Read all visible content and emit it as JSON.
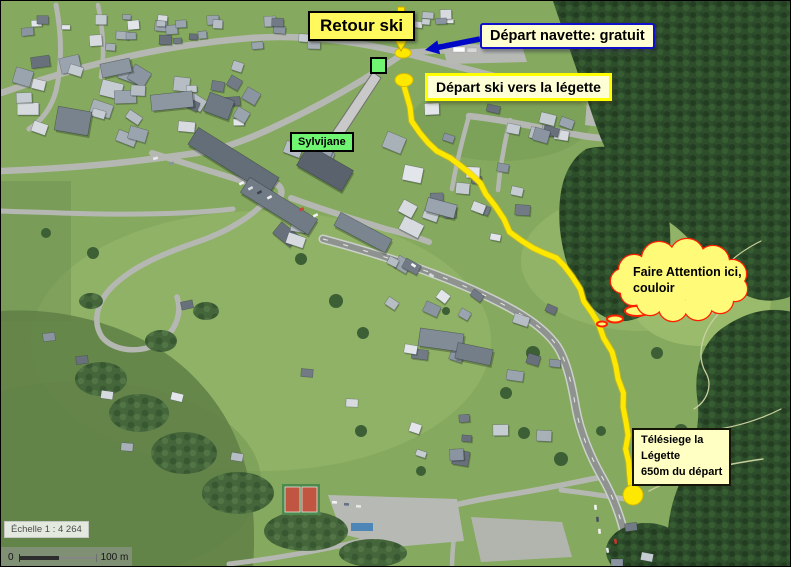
{
  "annotations": {
    "retour_ski": {
      "text": "Retour ski"
    },
    "depart_navette": {
      "text": "Départ navette: gratuit"
    },
    "depart_ski": {
      "text": "Départ ski vers la légette"
    },
    "sylvijane": {
      "text": "Sylvijane"
    },
    "warning": {
      "line1": "Faire Attention ici,",
      "line2": "couloir"
    },
    "telesiege": {
      "line1": "Télésiege la",
      "line2": "Légette",
      "line3": "650m du départ"
    }
  },
  "scale": {
    "label": "Échelle 1 : 4 264",
    "bar_start": "0",
    "bar_end": "100 m"
  },
  "colors": {
    "route_yellow": "#FFE800",
    "route_outline": "#E0BE00",
    "marker_yellow": "#FFE800",
    "marker_outline": "#D8B900",
    "cloud_fill": "#FFFA78",
    "warning_border_red": "#FF2000",
    "label_yellow_bg": "#FFF95E",
    "label_cream_bg": "#FFFFD6",
    "sylvijane_green": "#70F573",
    "navette_border_blue": "#0F0FCC",
    "arrow_blue": "#0008C8",
    "arrow_yellow": "#FFE800",
    "arrow_yellow_outline": "#C8A500",
    "callout_arrow_gray": "#C9C9C9"
  },
  "route": {
    "start": [
      403,
      85
    ],
    "points": [
      [
        405,
        92
      ],
      [
        408,
        106
      ],
      [
        412,
        120
      ],
      [
        418,
        132
      ],
      [
        427,
        142
      ],
      [
        437,
        150
      ],
      [
        448,
        157
      ],
      [
        459,
        164
      ],
      [
        469,
        172
      ],
      [
        478,
        182
      ],
      [
        486,
        193
      ],
      [
        494,
        205
      ],
      [
        502,
        218
      ],
      [
        510,
        231
      ],
      [
        520,
        240
      ],
      [
        532,
        247
      ],
      [
        544,
        252
      ],
      [
        554,
        257
      ],
      [
        564,
        265
      ],
      [
        572,
        276
      ],
      [
        578,
        288
      ],
      [
        584,
        300
      ],
      [
        590,
        311
      ],
      [
        597,
        323
      ],
      [
        604,
        337
      ],
      [
        610,
        351
      ],
      [
        615,
        365
      ],
      [
        618,
        378
      ],
      [
        621,
        392
      ],
      [
        623,
        406
      ],
      [
        625,
        420
      ],
      [
        626,
        434
      ],
      [
        626,
        448
      ],
      [
        627,
        461
      ],
      [
        628,
        473
      ],
      [
        631,
        484
      ]
    ],
    "end_circle": [
      632,
      494,
      10
    ],
    "start_ellipse": [
      403,
      79,
      9,
      6.5
    ],
    "shuttle_ellipse": [
      402,
      52,
      8,
      5
    ]
  },
  "markers": {
    "sylvijane_square": [
      370,
      57,
      15,
      15
    ]
  },
  "arrows": {
    "yellow_down": {
      "shaft": [
        396.5,
        6,
        7,
        28
      ],
      "head": [
        [
          391,
          34
        ],
        [
          409,
          34
        ],
        [
          400,
          50
        ]
      ]
    },
    "blue": [
      [
        478.4,
        35.3
      ],
      [
        437.2,
        43.5
      ],
      [
        436.3,
        39.4
      ],
      [
        424,
        49
      ],
      [
        439.1,
        53.2
      ],
      [
        438.2,
        49
      ],
      [
        479.5,
        40.7
      ]
    ],
    "gray_callout": [
      [
        331,
        132
      ],
      [
        344,
        132
      ],
      [
        380,
        77
      ],
      [
        372,
        71
      ]
    ]
  },
  "cloud": {
    "circles": [
      [
        633,
        269,
        15
      ],
      [
        658,
        258,
        17
      ],
      [
        686,
        255,
        17
      ],
      [
        712,
        261,
        16
      ],
      [
        731,
        273,
        14
      ],
      [
        734,
        288,
        12
      ],
      [
        719,
        299,
        13
      ],
      [
        697,
        305,
        14
      ],
      [
        672,
        306,
        14
      ],
      [
        649,
        301,
        13
      ],
      [
        632,
        292,
        12
      ],
      [
        622,
        280,
        12
      ]
    ],
    "center_ellipse": [
      678,
      281,
      50,
      18
    ],
    "trail": [
      [
        636,
        310,
        12,
        5
      ],
      [
        614,
        318,
        8,
        3.5
      ],
      [
        601,
        323,
        5,
        2.5
      ]
    ]
  }
}
